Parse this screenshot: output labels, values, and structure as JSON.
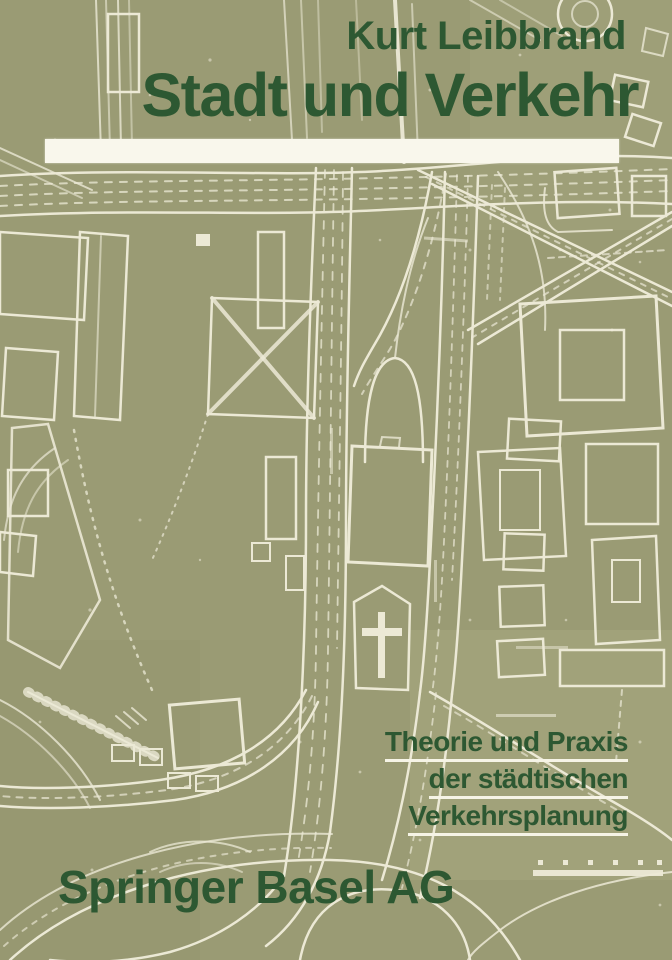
{
  "cover": {
    "author": "Kurt Leibbrand",
    "title": "Stadt und Verkehr",
    "subtitle_lines": [
      "Theorie und Praxis",
      "der städtischen",
      "Verkehrsplanung"
    ],
    "publisher": "Springer Basel AG",
    "colors": {
      "background_olive": "#9a9b74",
      "text_green": "#2d5832",
      "map_line_white": "#f3f0df",
      "title_bar_white": "#f9f7ec"
    }
  }
}
